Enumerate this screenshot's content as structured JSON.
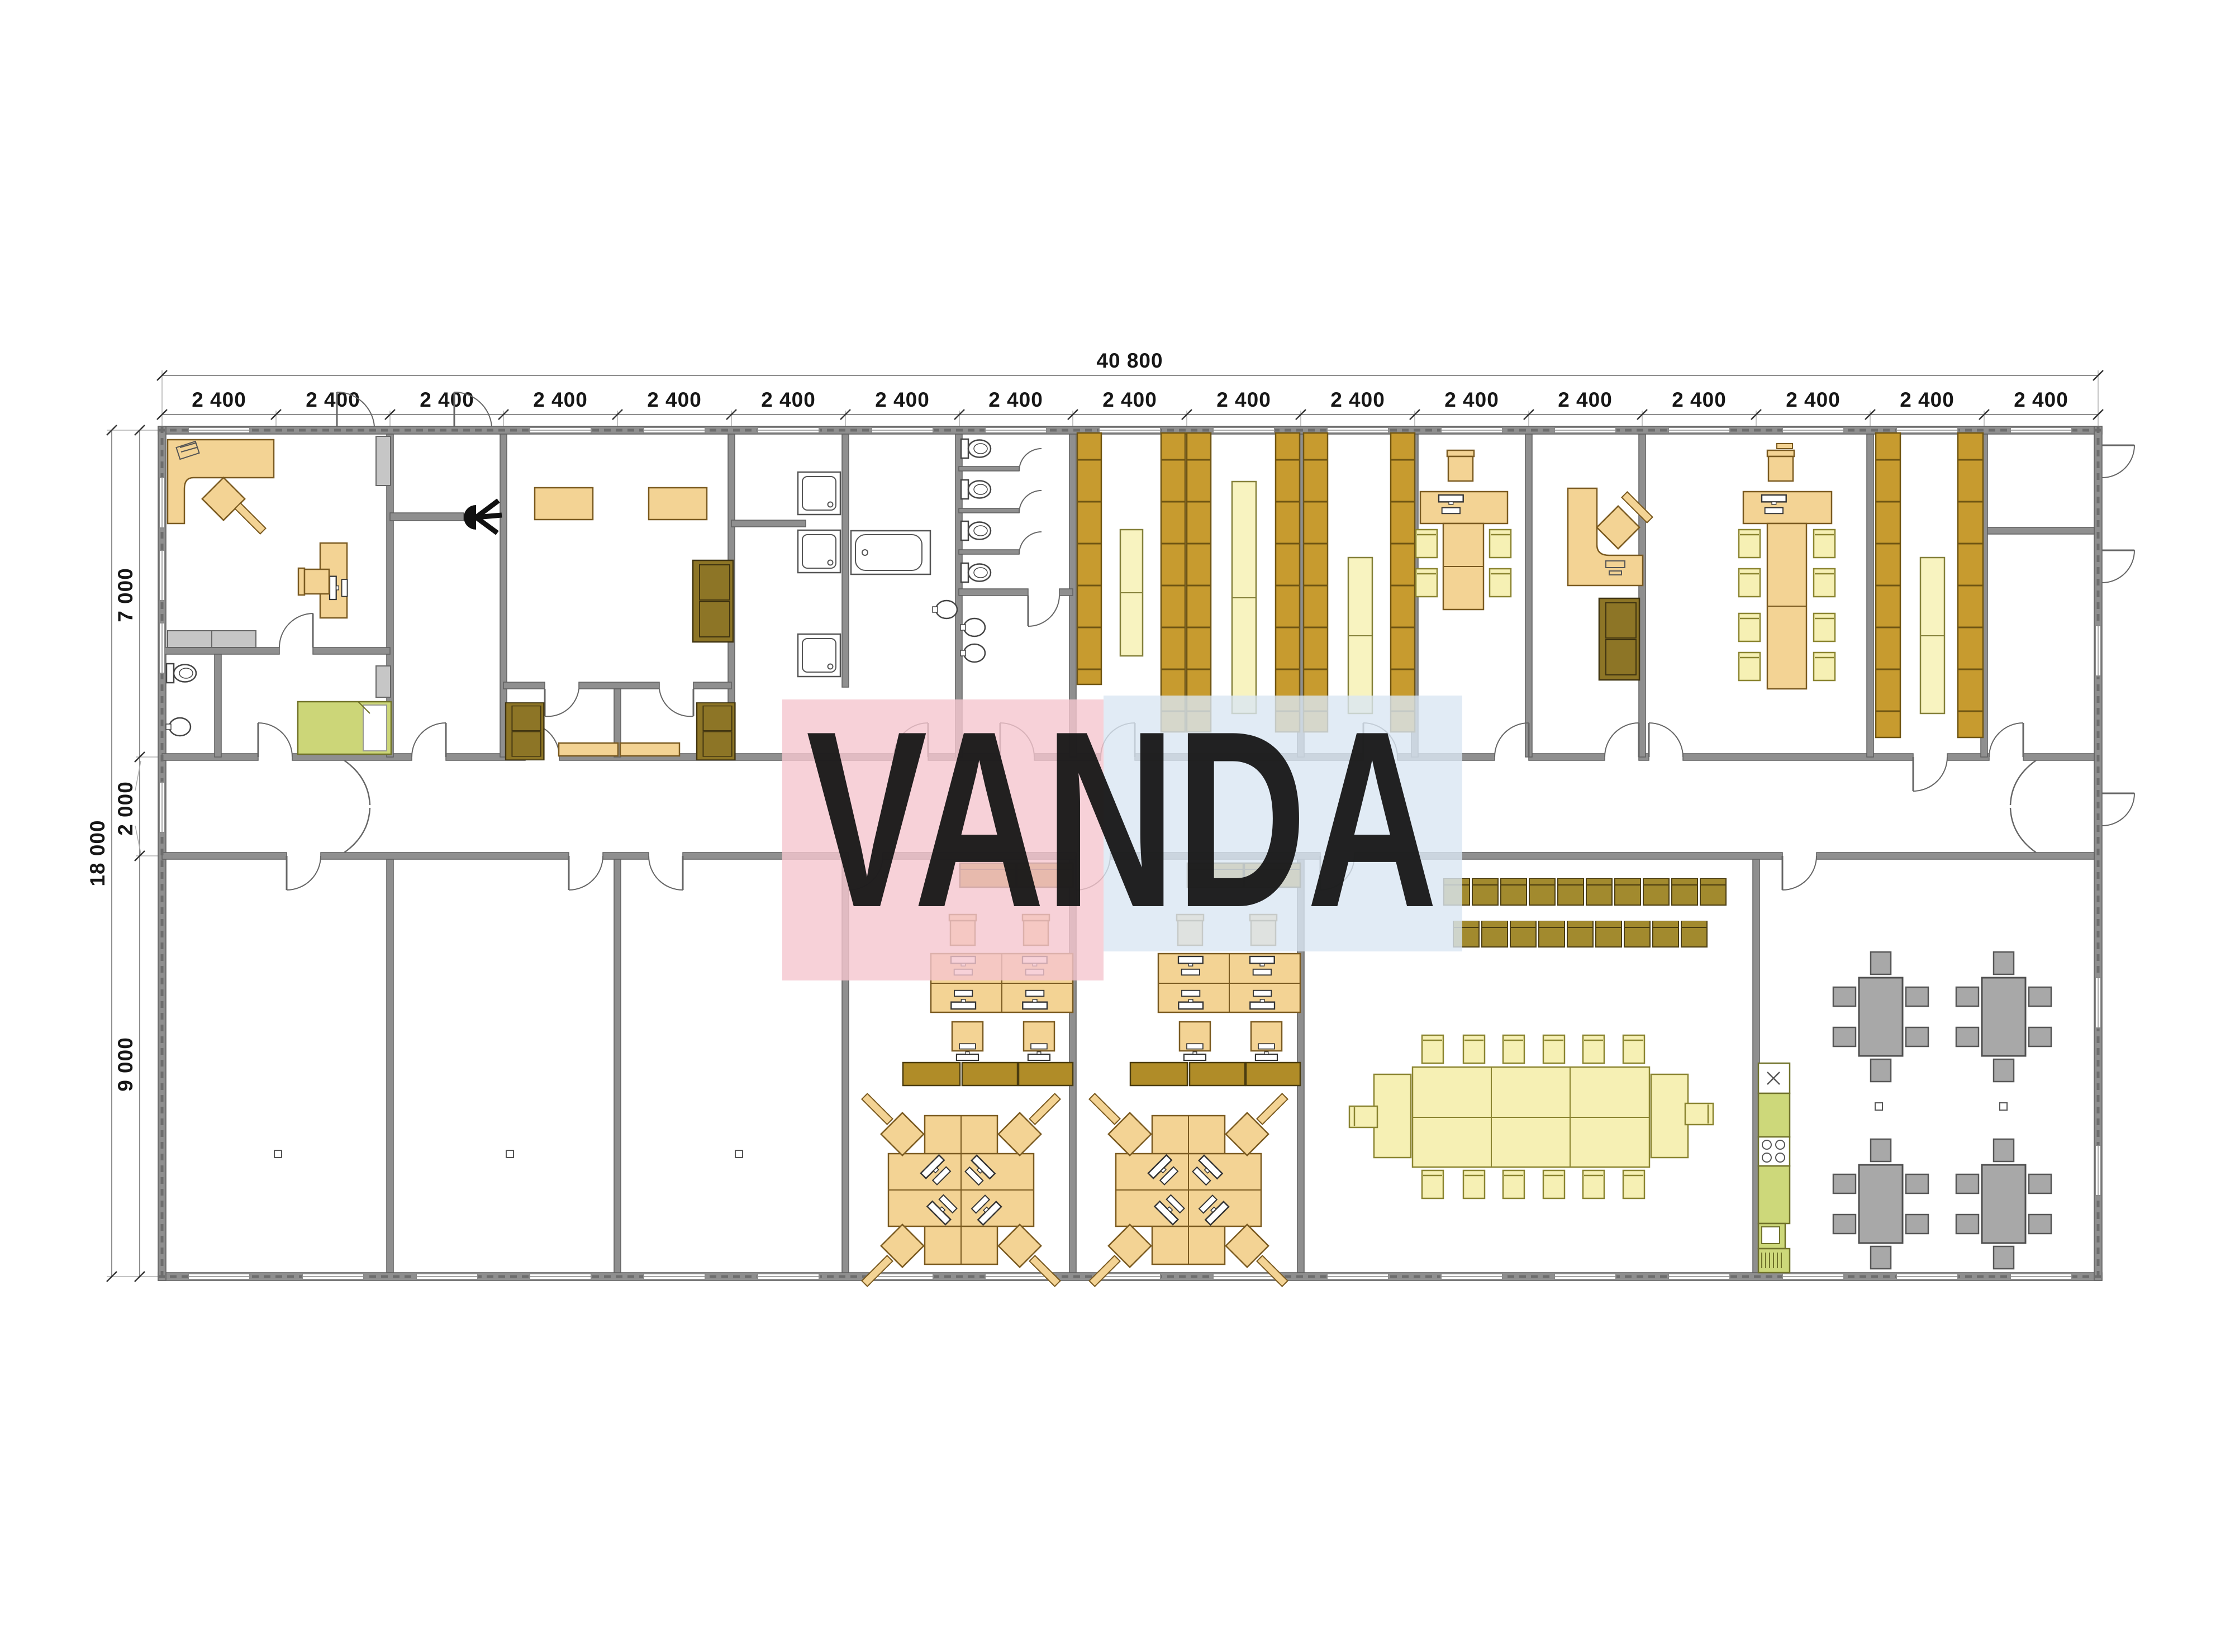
{
  "plan": {
    "watermark": {
      "text": "VANDA",
      "pink": "#f5c6ce",
      "blue": "#d9e6f2"
    },
    "dimensions": {
      "top_total": "40 800",
      "top_segments": [
        "2 400",
        "2 400",
        "2 400",
        "2 400",
        "2 400",
        "2 400",
        "2 400",
        "2 400",
        "2 400",
        "2 400",
        "2 400",
        "2 400",
        "2 400",
        "2 400",
        "2 400",
        "2 400",
        "2 400"
      ],
      "left_segments": [
        "7 000",
        "2 000",
        "9 000"
      ],
      "left_total": "18 000"
    },
    "colors": {
      "wall": "#8f8f8f",
      "desk_tan": "#f3d394",
      "shelf_ochre": "#c79b2f",
      "locker_olive": "#a28a2e",
      "cabinet_pale": "#f8f3c0",
      "bed_green": "#ccd678",
      "kitchen_green": "#cdd87a",
      "dining_gray": "#a8a8a8"
    }
  }
}
